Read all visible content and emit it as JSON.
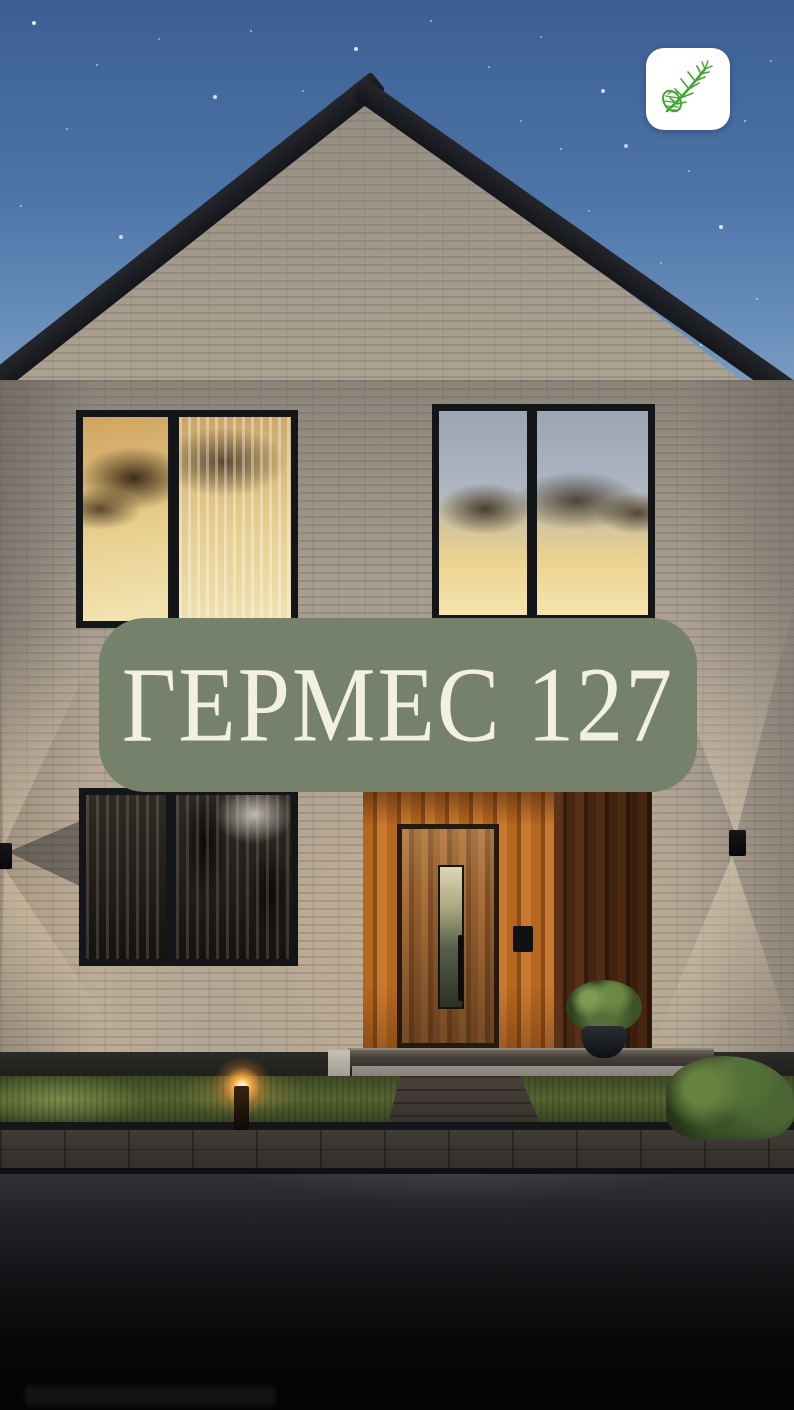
{
  "badge": {
    "title": "ГЕРМЕС 127"
  },
  "logo": {
    "icon": "pine-branch-icon"
  },
  "colors": {
    "badge_background": "#75816A",
    "badge_text": "#F2EFE3",
    "logo_background": "#FFFFFF",
    "logo_branch_green": "#44A335",
    "sky_top": "#3C5F93",
    "sky_horizon": "#8AABCD",
    "roof": "#1B1C20",
    "brick_wall": "#A89E90",
    "window_glow": "#EFD99B",
    "door_wood": "#B5661F",
    "lawn_green": "#55642F",
    "road": "#0A0A0C"
  }
}
